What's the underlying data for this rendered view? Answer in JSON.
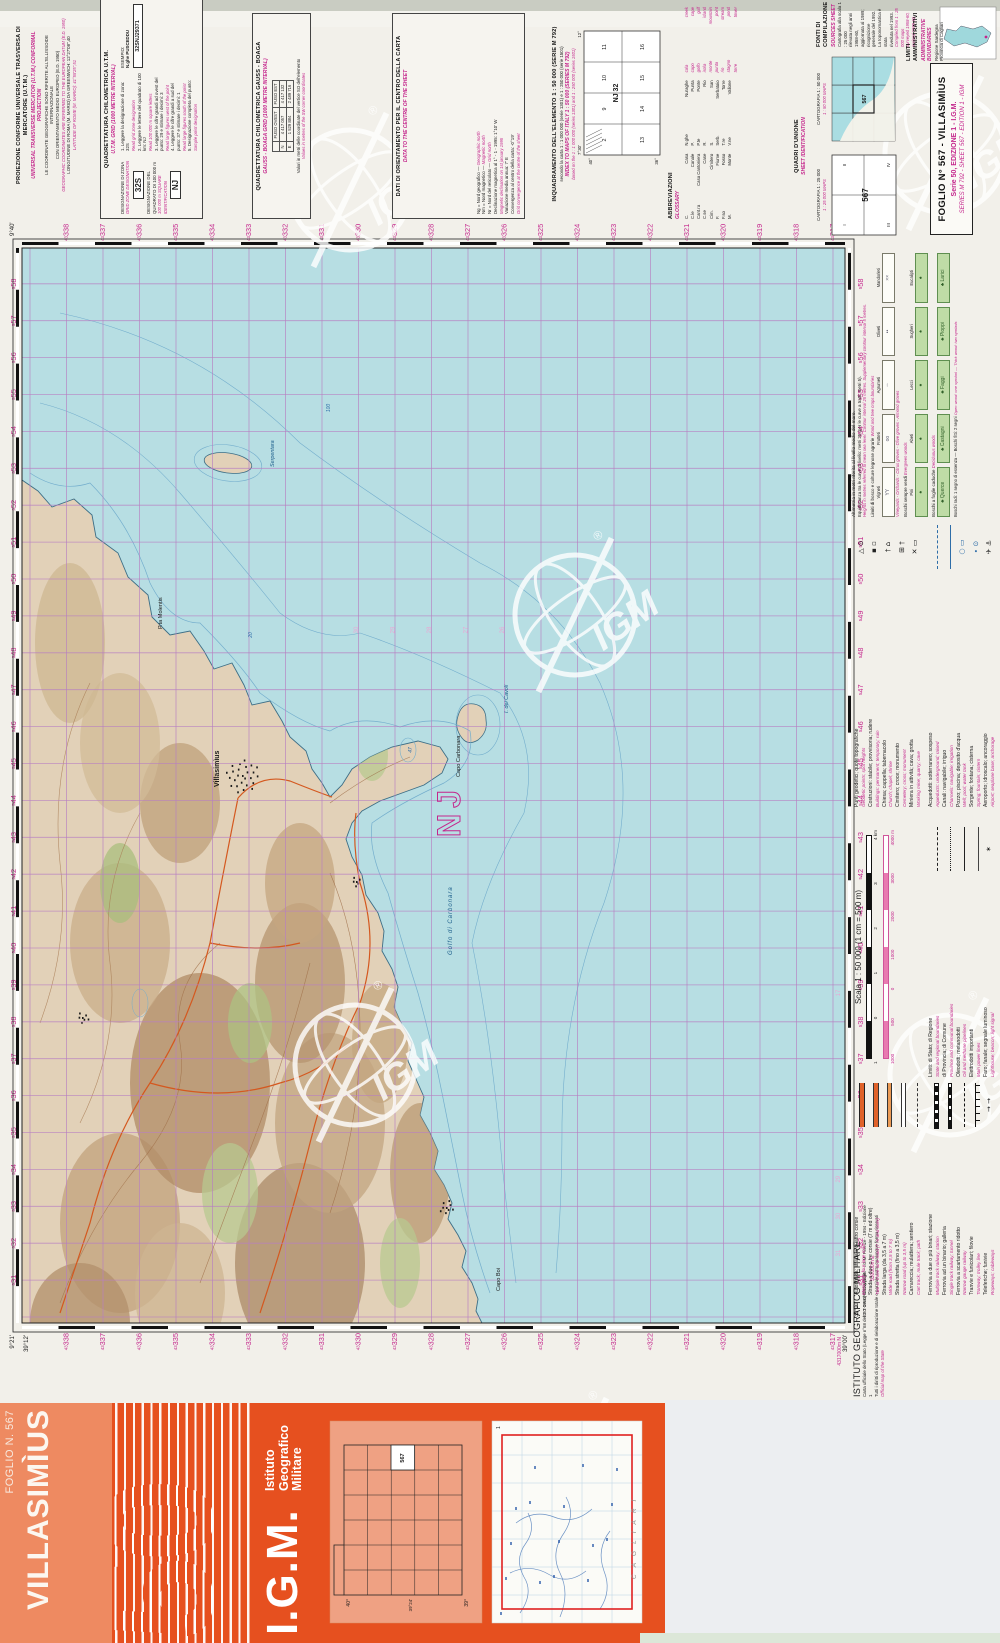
{
  "cover": {
    "foglio_label": "FOGLIO N. 567",
    "title": "VILLASIMÌUS",
    "serie_word": "SERIE",
    "serie_number": "50",
    "igm_abbrev": "I.G.M.",
    "igm_name": [
      "Istituto",
      "Geografico",
      "Militare"
    ],
    "index_panel": {
      "lat_top": "40°",
      "lat_mid": "39°24'",
      "lat_bot": "39°",
      "highlight": "567"
    },
    "loc_panel": {
      "city": "CAGLIARI",
      "page_no": "1"
    }
  },
  "colors": {
    "sea": "#b7dee3",
    "grid": "#b87fc2",
    "magenta": "#c4268c",
    "faint": "#eba6d4",
    "land": "#e2d1b8",
    "coast": "#3d6e86",
    "contour": "#74aecd",
    "road": "#d4581f",
    "orange": "#e6501f",
    "orange_light": "#ee8a61",
    "salmon": "#efa183"
  },
  "map": {
    "zone_label": "NJ",
    "eastings": {
      "prefix": "5",
      "from": 530,
      "to": 559
    },
    "northings": {
      "prefix": "43",
      "from": 339,
      "to": 317
    },
    "corners": {
      "lat_top": "39°12'",
      "lat_bottom": "39°00'",
      "lon_w": "9°21'",
      "lon_e": "9°40'",
      "greenwich": "EST DA GREENWICH",
      "full_e": "530000m E",
      "full_n": "4317000m N"
    },
    "interior_numbers": {
      "column": [
        "30",
        "29",
        "28",
        "27",
        "26"
      ],
      "bottom": [
        "31",
        "30",
        "29"
      ],
      "single": "17"
    },
    "places": [
      {
        "t": "Villasimìus",
        "x": 856,
        "y": 219,
        "c": "town"
      },
      {
        "t": "Capo Carbonara",
        "x": 866,
        "y": 460,
        "c": "cape"
      },
      {
        "t": "I. dei Cavoli",
        "x": 930,
        "y": 508,
        "c": "sea"
      },
      {
        "t": "Serpentara",
        "x": 1176,
        "y": 274,
        "c": "sea"
      },
      {
        "t": "Golfo di Carbonara",
        "x": 688,
        "y": 452,
        "c": "gulf"
      },
      {
        "t": "P.ta Molentis",
        "x": 1014,
        "y": 162,
        "c": "cape"
      },
      {
        "t": "Capo Boi",
        "x": 352,
        "y": 500,
        "c": "cape"
      }
    ],
    "depths": [
      {
        "t": "20",
        "x": 1008,
        "y": 252
      },
      {
        "t": "47",
        "x": 893,
        "y": 412
      },
      {
        "t": "100",
        "x": 1235,
        "y": 330
      }
    ]
  },
  "scalebar": {
    "title": "Scala 1 : 50 000 (1 cm = 500 m)",
    "km_ticks": [
      "1",
      "0",
      "1",
      "2",
      "3",
      "4 km"
    ],
    "m_ticks": [
      "1000",
      "500",
      "0",
      "1000",
      "2000",
      "3000",
      "4000 m"
    ]
  },
  "imprint": {
    "title": "ISTITUTO GEOGRAFICO MILITARE",
    "lines": [
      "Carta ufficiale dello Stato (Legge n°68 del 2-2-1960) © Copyright - I.G.M. Firenze - 1994 - Edizione 1",
      "Tutti i diritti di riproduzione e di rielaborazione totale o parziale sotto qualunque forma riservati"
    ],
    "official": "Official map of the State"
  },
  "title_box": {
    "line1": "FOGLIO N° 567 - VILLASIMÌUS",
    "line2": "Serie 50, EDIZIONE 1 - I.G.M.",
    "line3": "SERIES M 792 - SHEET 567 - EDITION 1 - IGM"
  },
  "watermark": {
    "text": "IGM",
    "reg": "®"
  },
  "legend": {
    "groups": [
      {
        "x": 348,
        "y": 854,
        "w": 212,
        "rows": [
          {
            "sym": "road-a",
            "it": "Autostrada; strada a quattro corsie",
            "en": "Motorway; four lane road"
          },
          {
            "sym": "road-2",
            "it": "Strada a due o tre corsie (7 m ed oltre)",
            "en": "Two or three lane road (7 m and over)"
          },
          {
            "sym": "road-w",
            "it": "Strada larga (da 3,5 a 7 m)",
            "en": "Wide road (from 3,5 to 7 m)"
          },
          {
            "sym": "road-n",
            "it": "Strada stretta (fino a 3,5 m)",
            "en": "Narrow road (up to 3,5 m)"
          },
          {
            "sym": "track",
            "it": "Carrareccia; mulattiera; sentiero",
            "en": "Cart track; mule track; path"
          }
        ]
      },
      {
        "x": 348,
        "y": 928,
        "w": 212,
        "rows": [
          {
            "sym": "rail2",
            "it": "Ferrovia a due o più binari; stazione",
            "en": "Multiple track railway; station"
          },
          {
            "sym": "rail1",
            "it": "Ferrovia ad un binario; galleria",
            "en": "Single track railway; tunnel"
          },
          {
            "sym": "railn",
            "it": "Ferrovia a scartamento ridotto",
            "en": "Narrow gauge railway"
          },
          {
            "sym": "tram",
            "it": "Tranvie e funicolari; filovie",
            "en": "Tramway; trolley line"
          },
          {
            "sym": "rope",
            "it": "Teleferiche; funivie",
            "en": "Ropeways; cableways"
          }
        ]
      },
      {
        "x": 566,
        "y": 928,
        "w": 250,
        "rows": [
          {
            "sym": "b1",
            "it": "Limiti: di Stato; di Regione",
            "en": "State and regional boundaries"
          },
          {
            "sym": "b2",
            "it": "di Provincia; di Comune",
            "en": "Province and communal boundaries"
          },
          {
            "sym": "pipe",
            "it": "Oleodotti; metanodotti",
            "en": "Oil and methane pipelines"
          },
          {
            "sym": "power",
            "it": "Elettrodotti importanti",
            "en": "Main power lines"
          },
          {
            "sym": "light",
            "it": "Faro; fanale; segnale luminoso",
            "en": "Lighthouse; beacon; light signal"
          }
        ]
      },
      {
        "x": 836,
        "y": 854,
        "w": 282,
        "rows": [
          {
            "sym": "geo",
            "it": "Punti geodetici; quote topografiche",
            "en": "Geodetic points; spot heights"
          },
          {
            "sym": "build",
            "it": "Costruzioni: stabile; provvisoria; rudere",
            "en": "Buildings: permanent; temporary; ruin"
          },
          {
            "sym": "church",
            "it": "Chiesa; cappella; tabernacolo",
            "en": "Church; chapel; shrine"
          },
          {
            "sym": "cem",
            "it": "Cimitero; croce; monumento",
            "en": "Cemetery; cross; monument"
          },
          {
            "sym": "mine",
            "it": "Miniera in attività; cava; grotta",
            "en": "Working mine; quarry; cave"
          }
        ]
      },
      {
        "x": 836,
        "y": 928,
        "w": 282,
        "rows": [
          {
            "sym": "aqua",
            "it": "Acquedotti: sotterraneo; sospeso",
            "en": "Aqueducts: underground; raised"
          },
          {
            "sym": "canal",
            "it": "Canali: navigabile; irriguo",
            "en": "Channels: navigable; irrigation"
          },
          {
            "sym": "well",
            "it": "Pozzo; piscina; deposito d'acqua",
            "en": "Well; pool; water tank"
          },
          {
            "sym": "spring",
            "it": "Sorgente; fontana; cisterna",
            "en": "Spring; fountain; cistern"
          },
          {
            "sym": "anchor",
            "it": "Aeroporto; idroscalo; ancoraggio",
            "en": "Airport; seaplane base; anchorage"
          }
        ]
      }
    ],
    "sym_glyphs": {
      "light": "✶",
      "geo": "△ ⊙",
      "build": "▪ ▫",
      "church": "† ⌂",
      "cem": "⊞ †",
      "mine": "✕ ▭",
      "well": "○ ▭",
      "spring": "∙ ⊙",
      "anchor": "✈ ⚓",
      "rope": "→ →"
    },
    "vegetation": {
      "alt1": "Altimetria in metri riferita al livello medio del mare.",
      "alt2": "Equidistanza tra le curve di livello: metri 25 (per le curve a tratti: metri 5).",
      "alt_en": "Heights in metres referred to mean sea level. Contour interval 25 metres. Supplementary contour interval 5 metres.",
      "crops_label": "Limiti di bosco e colture legnose agrarie",
      "crops_label_en": "Wood and tree crops boundaries",
      "crops": [
        "Vigneti",
        "Frutteti",
        "Agrumeti",
        "Oliveti",
        "Mandorleti"
      ],
      "crops_en": "Vineyards - Orchards - Citrus groves - Olive groves - Almond groves",
      "crops_glyphs": [
        "YY",
        "oo",
        "◦◦",
        "••",
        "××"
      ],
      "evergreen_label": "Boschi sempre verdi",
      "evergreen_label_en": "Evergreen woods",
      "evergreen": [
        "Pini",
        "Abeti",
        "Lecci",
        "Sugheri",
        "Eucalipti"
      ],
      "evergreen_glyph": "♠",
      "deciduous_label": "Boschi a foglie caduche",
      "deciduous_label_en": "Deciduous woods",
      "deciduous": [
        "Querce",
        "Castagni",
        "Faggi",
        "Pioppi",
        "Larici"
      ],
      "deciduous_glyph": "♣",
      "note": "Boschi radi: 1 segno di essenza — Boschi fitti: 2 segni",
      "note_en": "Open wood: one symbol — Thick wood: two symbols"
    }
  },
  "margin": {
    "projection": [
      [
        "PROIEZIONE CONFORME UNIVERSALE TRASVERSA DI MERCATORE (U.T.M.)",
        "K"
      ],
      [
        "UNIVERSAL TRANSVERSE MERCATOR (U.T.M.) CONFORMAL PROJECTION",
        "M"
      ],
      [
        "LE COORDINATE GEOGRAFICHE SONO RIFERITE ALL'ELLISSOIDE INTERNAZIONALE",
        "k"
      ],
      [
        "CON ORIENTAMENTO MEDIO EUROPEO (E.D. 1950)",
        "k"
      ],
      [
        "GEOGRAPHIC COORDINATES ARE REFERRED TO THE EUROPEAN DATUM (E.D. 1950)",
        "m"
      ],
      [
        "LONGITUDINE DI ROMA (M. MARIO) DA GREENWICH: 12°27'08\",40",
        "k"
      ],
      [
        "LATITUDE OF ROME (M. MARIO): 41°55'25\",51",
        "m"
      ]
    ],
    "utm": {
      "title_it": "QUADRETTATURA CHILOMETRICA U.T.M.",
      "title_en": "U.T.M. GRID (1000 METRE INTERVAL)",
      "zone_label_it": "DESIGNAZIONE DI ZONA",
      "zone_label_en": "GRID ZONE DESIGNATION",
      "zone_value": "32S",
      "square_label_it": "DESIGNAZIONE DEL QUADRATO DI 100 000 m",
      "square_label_en": "100 000 m SQUARE IDENTIFICATION",
      "square_value": "NJ",
      "steps": [
        [
          "1. Leggere la designazione di zona: 32S",
          "Read grid zone designation"
        ],
        [
          "2. Leggere le lettere del quadrato di 100 km: NJ",
          "Read 100 000 m square letters"
        ],
        [
          "3. Leggere le cifre grandi ad ovest del punto: 29 e stimare i decimi: 3",
          "Read large figures west of the point"
        ],
        [
          "4. Leggere le cifre grandi a sud del punto: 37 e stimare i decimi: 1",
          "Read large figures south of the point"
        ],
        [
          "5. Designazione completa del punto:",
          "Sample point designation"
        ]
      ],
      "example_label": "ESEMPIO:",
      "example_point": "N.ghe PUSCEDDU",
      "example_ref": "32SNJ29371"
    },
    "gauss": {
      "title_it": "QUADRETTATURA CHILOMETRICA GAUSS - BOAGA",
      "title_en": "GAUSS - BOAGA GRID (1000 METRE INTERVAL)",
      "table_head": [
        "",
        "FUSO OVEST",
        "FUSO EST"
      ],
      "table_rows": [
        [
          "N",
          "4 417 057",
          "4 417 132"
        ],
        [
          "E",
          "1 529 884",
          "2 489 716"
        ]
      ],
      "note_it": "Valori in metri delle coordinate del vertice SO dell'elemento",
      "note_en": "Values in metres of the SW corner coordinates"
    },
    "orient": {
      "title_it": "DATI DI ORIENTAMENTO PER IL CENTRO DELLA CARTA",
      "title_en": "DATA TO THE CENTRE OF THE SHEET",
      "legend": [
        [
          "Ng = Nord geografico",
          "Geographic north"
        ],
        [
          "Nm = Nord magnetico",
          "Magnetic north"
        ],
        [
          "Nr = Nord del reticolato",
          "Grid north"
        ]
      ],
      "lines": [
        [
          "Declinazione magnetica al 1° - 1 - 1995: 1°10' W",
          "k"
        ],
        [
          "Magnetic declination on 1st january 1995",
          "m"
        ],
        [
          "Variazione media annua: 7' E",
          "k"
        ],
        [
          "Convergenza al centro della carta: -0°19'",
          "k"
        ],
        [
          "Grid convergence at the centre of the sheet",
          "m"
        ]
      ],
      "diagram_labels": {
        "ng": "Ng",
        "nm": "Nm",
        "nr": "Nr",
        "delta": "δ",
        "eps": "ε"
      }
    },
    "inq": {
      "lines": [
        [
          "INQUADRAMENTO DELL'ELEMENTO 1 : 50 000 (SERIE M 792)",
          "K"
        ],
        [
          "secondo la carta 1 : 1 000 000 (serie 1301) e 1 : 250 000 (serie 1501)",
          "k"
        ],
        [
          "INDEX TO MAPS OF ITALY 1 : 50 000 (SERIES M 792)",
          "M"
        ],
        [
          "based on the 1 : 1 000 000 (series 1301) and 1 : 250 000 (series 1501)",
          "m"
        ]
      ],
      "diagram_title": "NJ 32",
      "cells_top": [
        "2",
        "9",
        "10",
        "11"
      ],
      "cells_bottom": [
        "13",
        "14",
        "15",
        "16"
      ],
      "corner_nw": "7°30'",
      "corner_ne": "12°",
      "corner_w_top": "40°",
      "corner_w_bot": "36°"
    },
    "abbrev": {
      "title_it": "ABBREVIAZIONI",
      "title_en": "GLOSSARY",
      "col1": [
        [
          "C.",
          "Casa"
        ],
        [
          "C.le",
          "Canale"
        ],
        [
          "Cant.ra",
          "Casa Cantoniera"
        ],
        [
          "C.se",
          "Case"
        ],
        [
          "Cim.",
          "Cimitero"
        ],
        [
          "F.",
          "Fiume"
        ],
        [
          "F.so",
          "Fosso"
        ],
        [
          "M.",
          "Monte"
        ]
      ],
      "col2": [
        [
          "N.ghe",
          "Nuraghe"
        ],
        [
          "P.",
          "Punta"
        ],
        [
          "P.te",
          "Ponte"
        ],
        [
          "R.",
          "Rio"
        ],
        [
          "S.",
          "San"
        ],
        [
          "Serb.",
          "Serbatoio"
        ],
        [
          "T.re",
          "Torre"
        ],
        [
          "V.ne",
          "Vallone"
        ]
      ],
      "glossary": [
        [
          "cala",
          "creek"
        ],
        [
          "capo",
          "cape"
        ],
        [
          "golfo",
          "gulf"
        ],
        [
          "isola",
          "island"
        ],
        [
          "monte",
          "mountain"
        ],
        [
          "punta",
          "point"
        ],
        [
          "rio",
          "stream"
        ],
        [
          "stagno",
          "pond"
        ],
        [
          "torre",
          "tower"
        ]
      ]
    },
    "quadri": {
      "title_it": "QUADRI D'UNIONE",
      "title_en": "SHEET IDENTIFICATION",
      "c25_it": "CARTOGRAFIA 1 : 25 000",
      "c25_en": "1 : 25 000 MAPS",
      "c25_quadrants": [
        "I",
        "II",
        "III",
        "IV"
      ],
      "c25_center": "567",
      "c50_it": "CARTOGRAFIA 1 : 50 000",
      "c50_en": "1 : 50 000 MAPS",
      "c50_center": "567",
      "fonti_title_it": "FONTI DI COMPILAZIONE",
      "fonti_title_en": "SOURCES SHEET",
      "fonti_lines": [
        [
          "Cartografia alla scala 1 : 25 000",
          "k"
        ],
        [
          "rilevata negli anni 1958-60,",
          "k"
        ],
        [
          "aggiornata al 1989; ricognizione",
          "k"
        ],
        [
          "generale del 1992.",
          "k"
        ],
        [
          "La toponomastica è stata",
          "k"
        ],
        [
          "riveduta nel 1993.",
          "k"
        ],
        [
          "Compiled from 1 : 25 000 maps",
          "m"
        ],
        [
          "surveyed 1958-60, revised 1989-92.",
          "m"
        ]
      ],
      "limiti_title_it": "LIMITI AMMINISTRATIVI",
      "limiti_title_en": "ADMINISTRATIVE BOUNDARIES",
      "limiti_labels": [
        "Regione Sardegna",
        "Provincia di Cagliari"
      ]
    }
  }
}
